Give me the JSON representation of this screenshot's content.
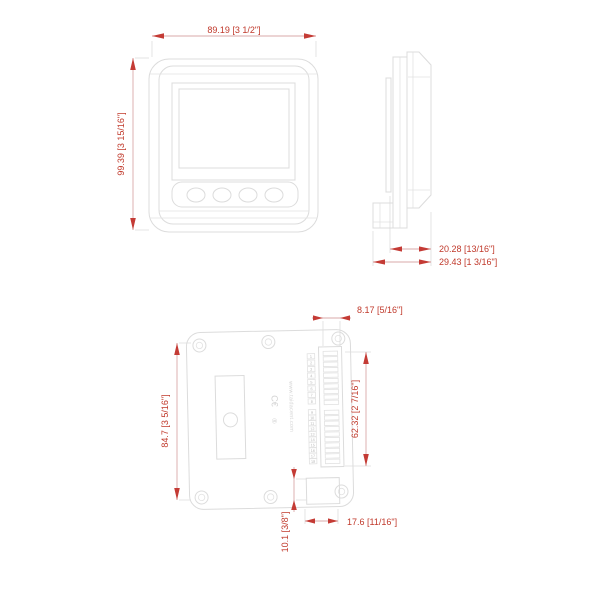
{
  "drawing": {
    "front": {
      "dim_width": "89.19 [3 1/2\"]",
      "dim_height": "99.39 [3 15/16\"]"
    },
    "side": {
      "dim_depth_behind_panel": "20.28 [13/16\"]",
      "dim_depth_total": "29.43 [1 3/16\"]"
    },
    "back": {
      "dim_terminal_offset": "8.17 [5/16\"]",
      "dim_body_height": "84.7 [3 5/16\"]",
      "dim_terminal_height": "62.32 [2 7/16\"]",
      "dim_connector_height": "10.1 [3/8\"]",
      "dim_connector_width": "17.6 [11/16\"]",
      "watermark": "www.taidacent.com",
      "ce_mark": "C€",
      "registered_mark": "®",
      "terminal_numbers_top": [
        "1",
        "2",
        "3",
        "4",
        "5",
        "6",
        "7",
        "8"
      ],
      "terminal_numbers_bottom": [
        "9",
        "10",
        "11",
        "12",
        "13",
        "14",
        "15",
        "16",
        "17",
        "18"
      ]
    },
    "colors": {
      "dimension_red": "#c0392b",
      "line_gray": "#dcdcdc"
    }
  }
}
